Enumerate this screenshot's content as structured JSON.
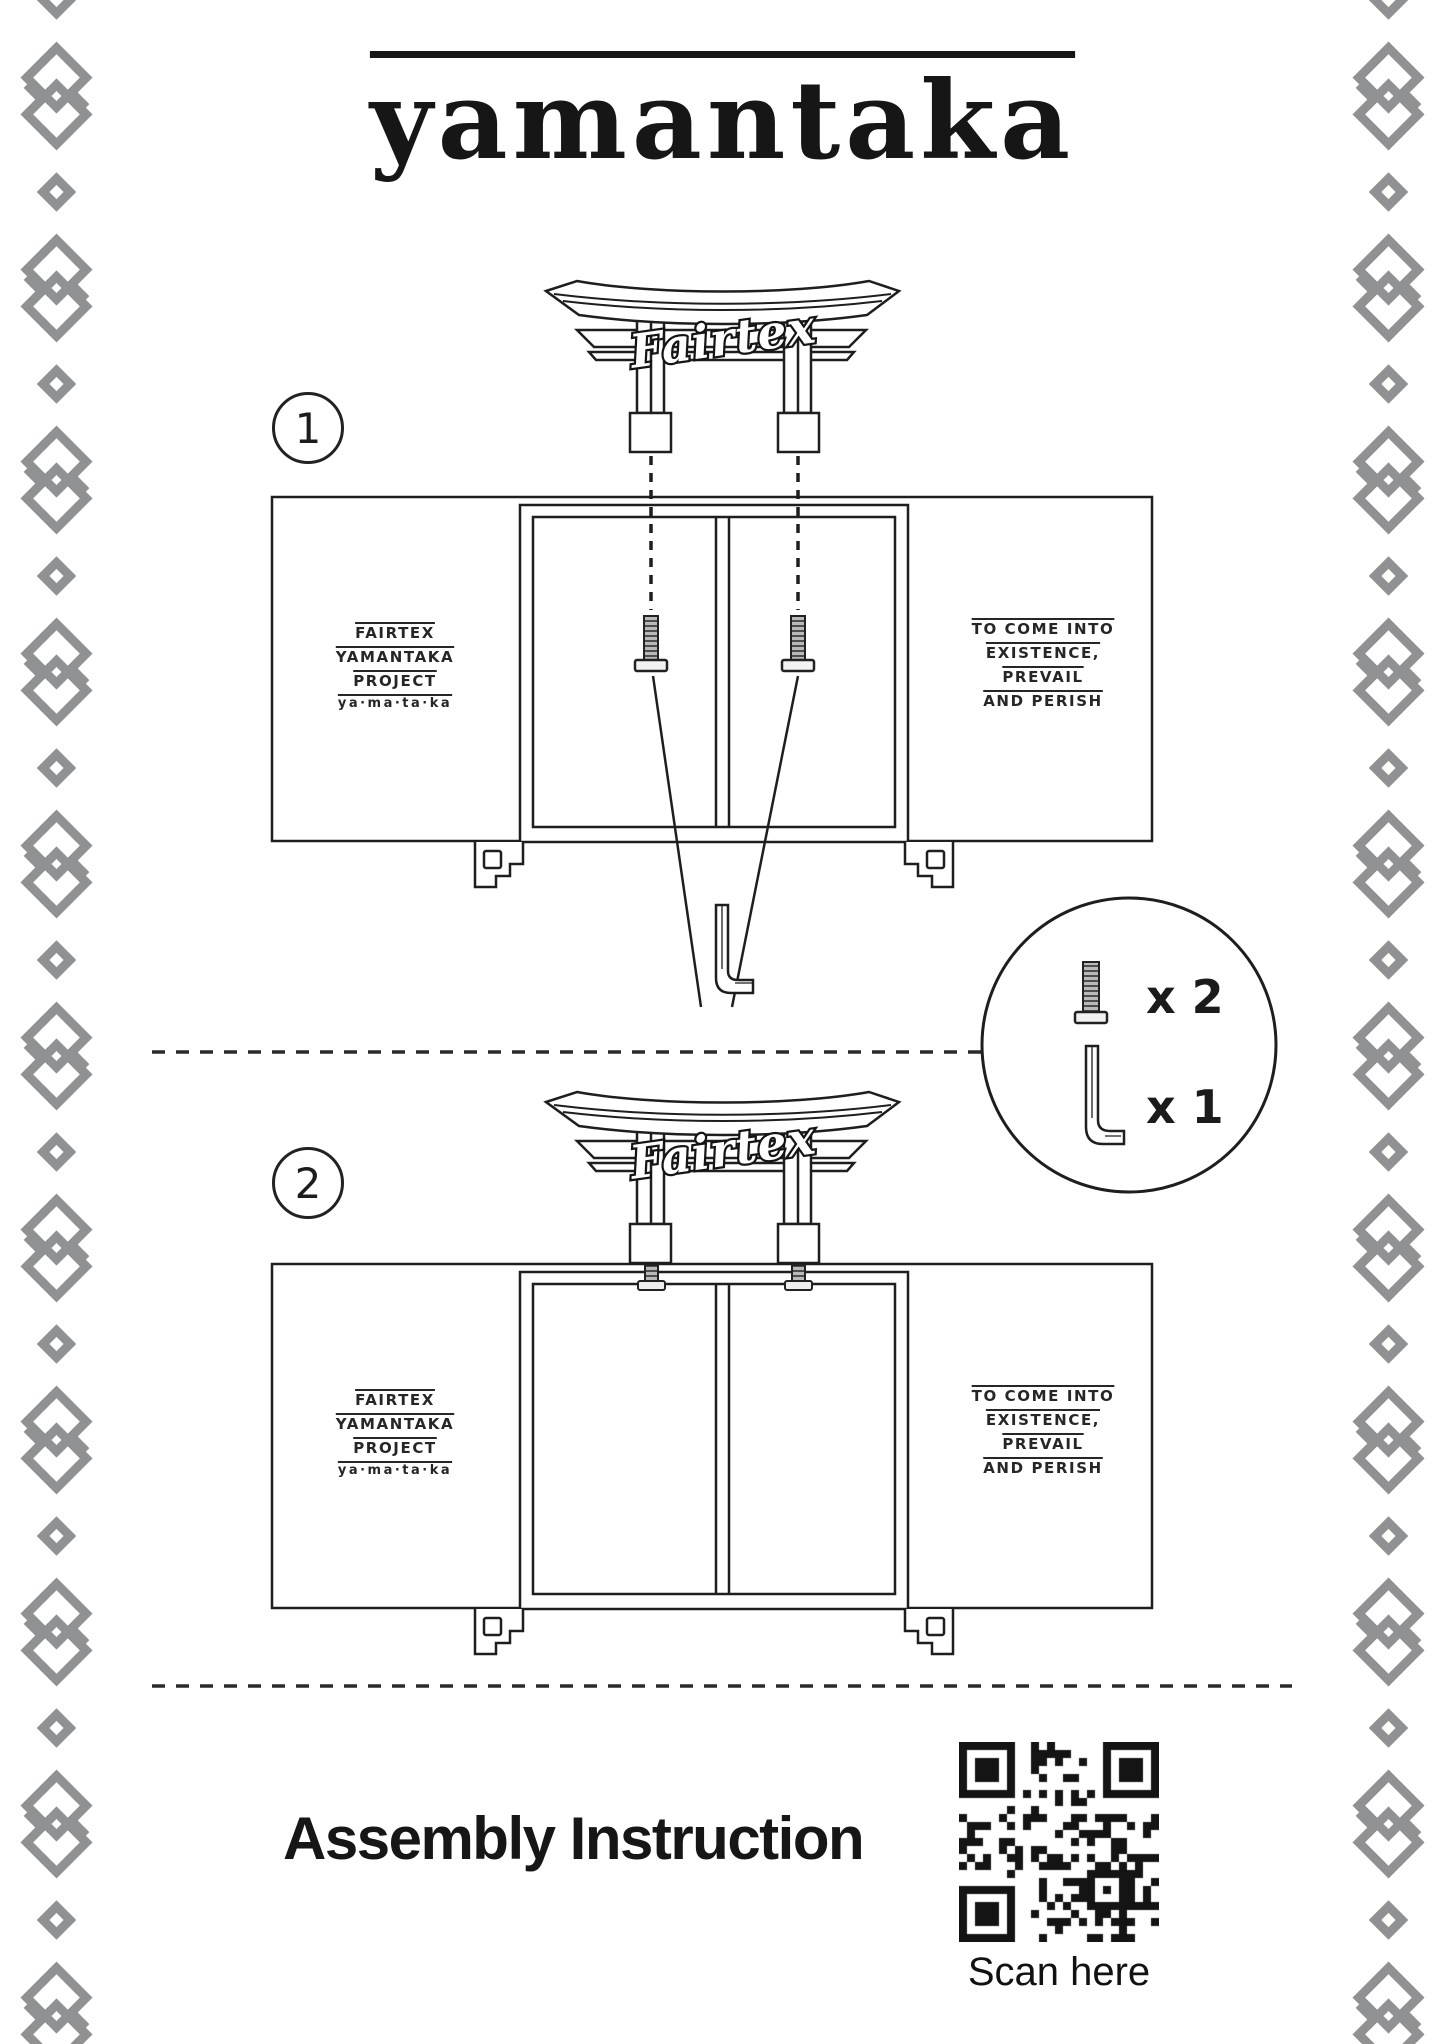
{
  "title": "yamantaka",
  "step1": {
    "number": "1",
    "logo": "Fairtex",
    "left_panel": {
      "l1": "FAIRTEX",
      "l2": "YAMANTAKA",
      "l3": "PROJECT",
      "l4": "ya·ma·ta·ka"
    },
    "right_panel": {
      "l1": "TO COME INTO",
      "l2": "EXISTENCE,",
      "l3": "PREVAIL",
      "l4": "AND PERISH"
    }
  },
  "step2": {
    "number": "2",
    "logo": "Fairtex",
    "left_panel": {
      "l1": "FAIRTEX",
      "l2": "YAMANTAKA",
      "l3": "PROJECT",
      "l4": "ya·ma·ta·ka"
    },
    "right_panel": {
      "l1": "TO COME INTO",
      "l2": "EXISTENCE,",
      "l3": "PREVAIL",
      "l4": "AND PERISH"
    }
  },
  "parts_legend": {
    "bolt_qty": "x 2",
    "allen_key_qty": "x 1"
  },
  "footer": {
    "heading": "Assembly Instruction",
    "qr_caption": "Scan here"
  },
  "colors": {
    "line": "#1e1e1e",
    "border_knot": "#8f9193",
    "dash": "#2b2b2b"
  }
}
